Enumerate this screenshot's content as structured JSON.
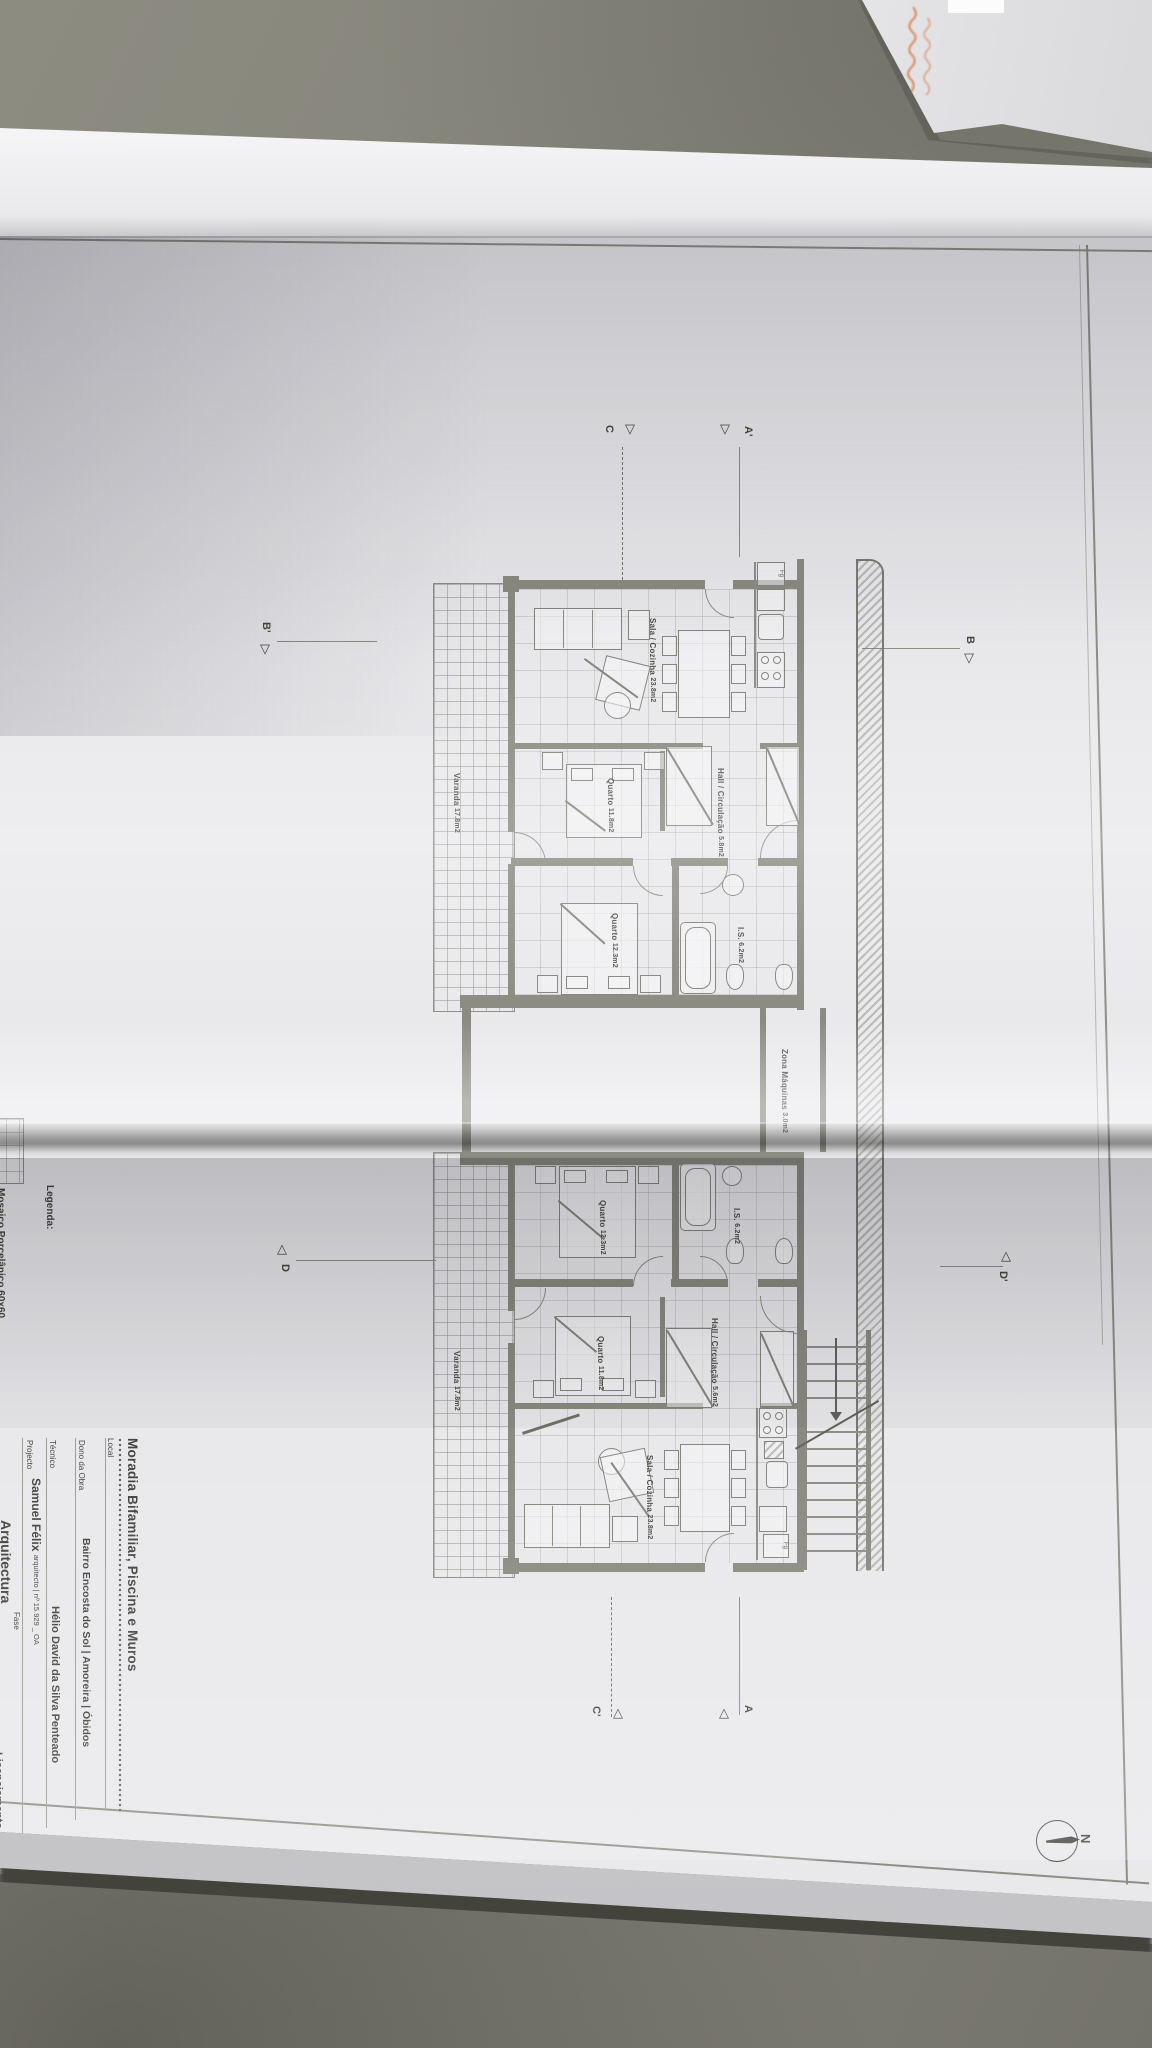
{
  "colors": {
    "desk": "#85847a",
    "paper": "#e9e9ec",
    "ink": "#3c3c36",
    "plan_line": "#80807a",
    "envelope_text_orange": "#d98a5c"
  },
  "title_block": {
    "title": "Moradia Bifamiliar, Piscina e Muros",
    "local": {
      "label": "Local",
      "value": "Bairro Encosta do Sol | Amoreira | Óbidos"
    },
    "dono": {
      "label": "Dono da Obra",
      "value": "Hélio David da Silva Penteado"
    },
    "tecnico": {
      "label": "Técnico",
      "name": "Samuel Félix",
      "credentials": "arquitecto | nº 15.929 _ OA"
    },
    "projecto": {
      "label": "Projecto",
      "value": "Arquitectura"
    },
    "fase": {
      "label": "Fase",
      "value": "Licenciamento"
    }
  },
  "legend": {
    "label": "Legenda:",
    "item": "Mosaico Porcelânico 60x60"
  },
  "plan": {
    "north_label": "N",
    "fridge_label": "Fg",
    "section_markers": {
      "a": "A",
      "a_prime": "A'",
      "b": "B",
      "b_prime": "B'",
      "c": "C",
      "c_prime": "C'",
      "d": "D",
      "d_prime": "D'"
    },
    "rooms": {
      "upper_sala": {
        "name": "Sala / Cozinha",
        "area": "23.8m2"
      },
      "upper_quarto1": {
        "name": "Quarto",
        "area": "11.8m2"
      },
      "upper_quarto2": {
        "name": "Quarto",
        "area": "12.3m2"
      },
      "upper_is": {
        "name": "I.S.",
        "area": "6.2m2"
      },
      "upper_hall": {
        "line1": "Hall /",
        "line2": "Circulação",
        "area": "5.8m2"
      },
      "upper_varanda": {
        "name": "Varanda",
        "area": "17.8m2"
      },
      "lower_sala": {
        "name": "Sala / Cozinha",
        "area": "23.8m2"
      },
      "lower_quarto1": {
        "name": "Quarto",
        "area": "11.8m2"
      },
      "lower_quarto2": {
        "name": "Quarto",
        "area": "12.3m2"
      },
      "lower_is": {
        "name": "I.S.",
        "area": "6.2m2"
      },
      "lower_hall": {
        "line1": "Hall /",
        "line2": "Circulação",
        "area": "5.6m2"
      },
      "lower_varanda": {
        "name": "Varanda",
        "area": "17.8m2"
      },
      "zona_maquinas": {
        "name": "Zona Máquinas",
        "area": "3.0m2"
      }
    }
  }
}
